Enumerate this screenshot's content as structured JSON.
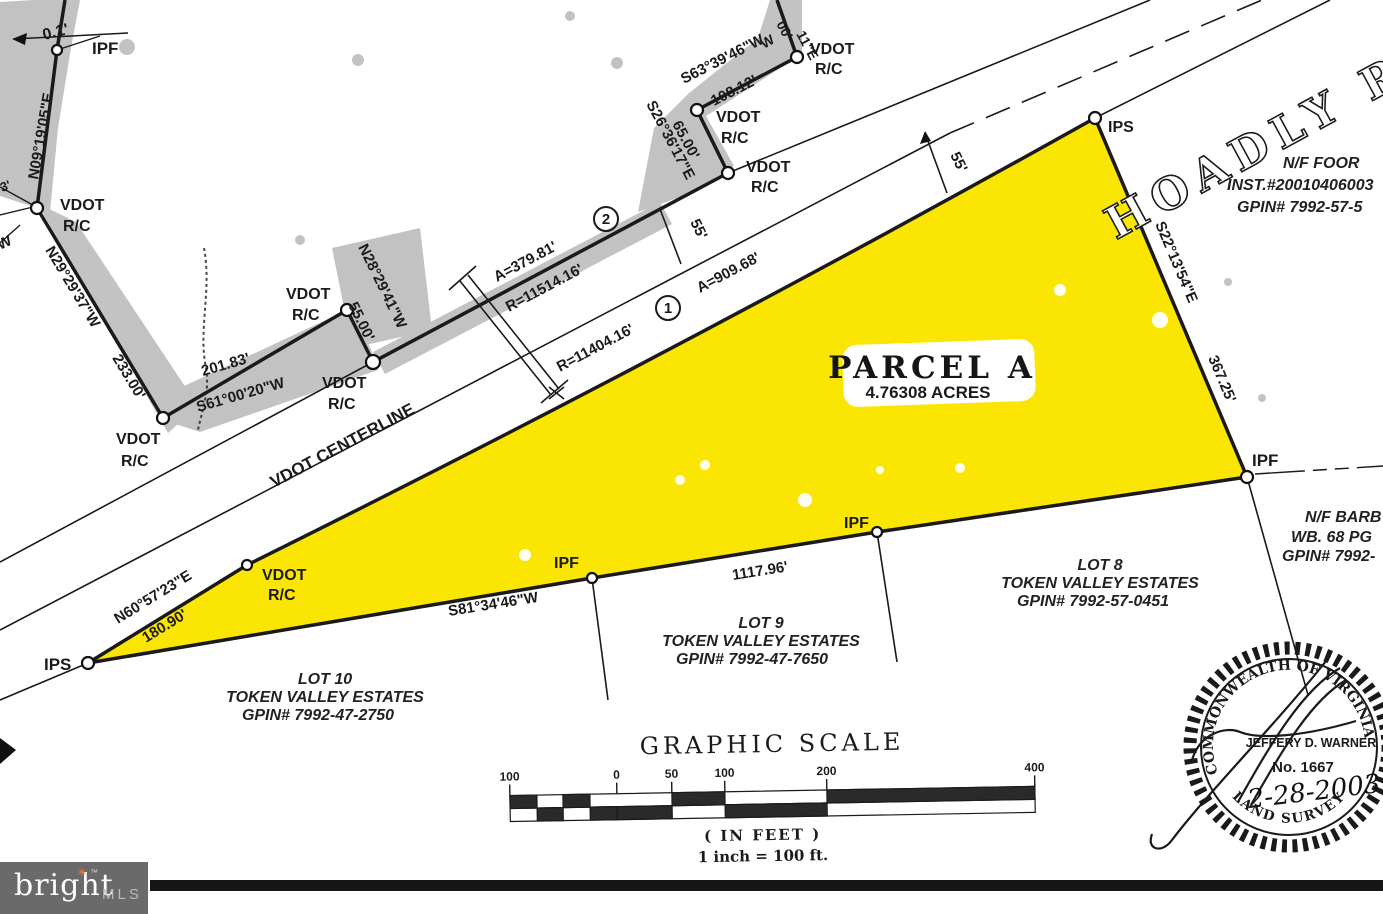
{
  "map": {
    "road": {
      "name": "HOADLY RO",
      "centerline": "VDOT CENTERLINE"
    },
    "parcel": {
      "title": "PARCEL A",
      "area": "4.76308 ACRES"
    },
    "markers": {
      "ipf": "IPF",
      "ips": "IPS",
      "vdot1": "VDOT",
      "vdot2": "R/C"
    },
    "curves": {
      "c1_id": "1",
      "c1_arc": "A=909.68'",
      "c1_radius": "R=11404.16'",
      "c2_id": "2",
      "c2_arc": "A=379.81'",
      "c2_radius": "R=11514.16'"
    },
    "bearings": {
      "n09": "N09°19'05\"E",
      "n29": "N29°29'37\"W",
      "d233": "233.00'",
      "s61": "S61°00'20\"W",
      "d201": "201.83'",
      "n28": "N28°29'41\"W",
      "d55": "55.00'",
      "s63": "S63°39'46\"W",
      "d108": "108.12'",
      "s26": "S26°36'17\"E",
      "d65": "65.00'",
      "s22": "S22°13'54\"E",
      "d367": "367.25'",
      "s81": "S81°34'46\"W",
      "d1117": "1117.96'",
      "n60": "N60°57'23\"E",
      "d180": "180.90'"
    },
    "dims": {
      "d55": "55'",
      "offset": "0.1'"
    },
    "fragments": {
      "f3": "3'",
      "w1": "W",
      "w2": "W",
      "f00": "00'",
      "f11e": "11\"E"
    },
    "adjoiners": {
      "foor": {
        "line1": "N/F FOOR",
        "line2": "INST.#20010406003",
        "line3": "GPIN# 7992-57-5"
      },
      "barb": {
        "line1": "N/F BARB",
        "line2": "WB. 68 PG",
        "line3": "GPIN# 7992-"
      },
      "lot8": {
        "line1": "LOT 8",
        "line2": "TOKEN VALLEY ESTATES",
        "line3": "GPIN# 7992-57-0451"
      },
      "lot9": {
        "line1": "LOT 9",
        "line2": "TOKEN VALLEY ESTATES",
        "line3": "GPIN# 7992-47-7650"
      },
      "lot10": {
        "line1": "LOT 10",
        "line2": "TOKEN VALLEY ESTATES",
        "line3": "GPIN# 7992-47-2750"
      }
    }
  },
  "scale": {
    "title": "GRAPHIC SCALE",
    "ticks": [
      "100",
      "0",
      "50",
      "100",
      "200",
      "400"
    ],
    "in_feet": "( IN FEET )",
    "ratio": "1 inch = 100 ft."
  },
  "seal": {
    "arc_top": "COMMONWEALTH OF VIRGINIA",
    "name": "JEFFERY D. WARNER",
    "number": "No. 1667",
    "date": "2-28-2003",
    "arc_bottom": "LAND SURVEYOR"
  },
  "logo": {
    "brand": "bright",
    "tm": "™",
    "mls": "MLS"
  },
  "colors": {
    "parcel_yellow": "#fbe502",
    "shading_gray": "#bcbcbc",
    "ink": "#1b1b1b",
    "logo_bg": "#6a6a6a",
    "logo_star": "#e1702d"
  }
}
